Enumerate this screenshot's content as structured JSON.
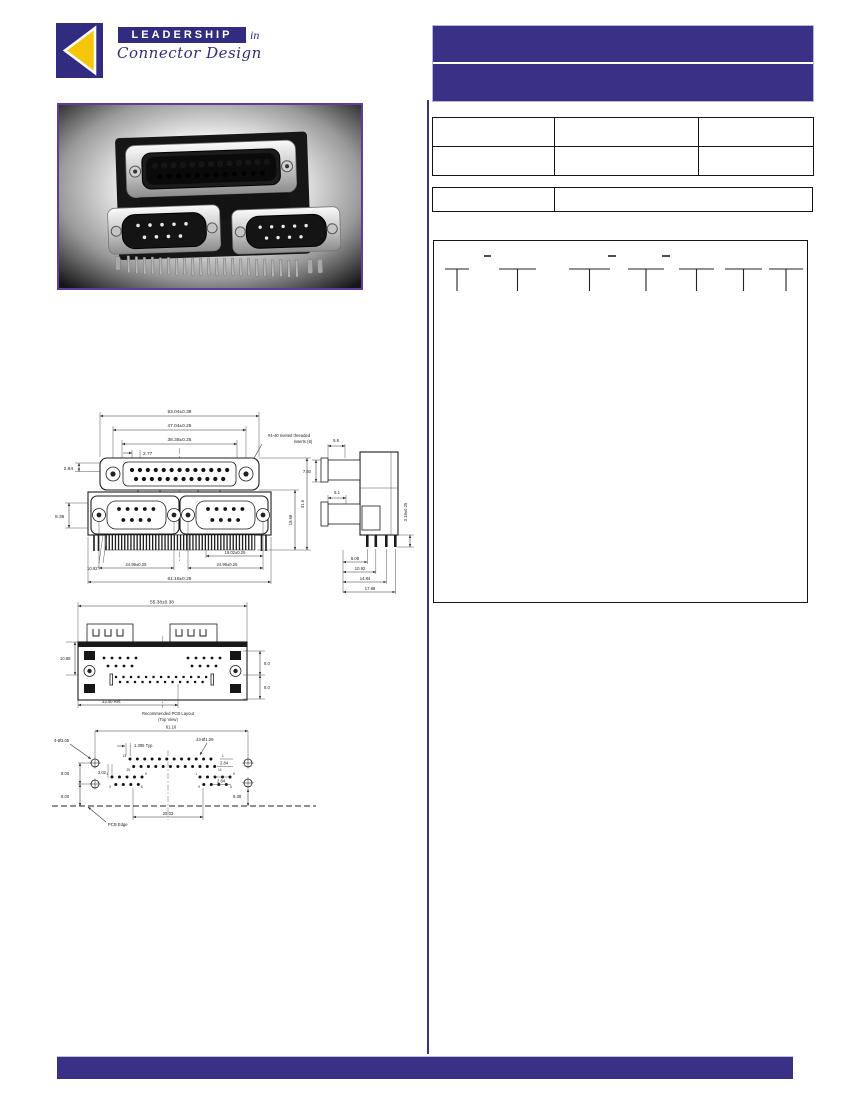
{
  "logo": {
    "leadership": "LEADERSHIP",
    "in": "in",
    "tagline": "Connector Design"
  },
  "colors": {
    "purple": "#3a3187",
    "navy": "#322c80",
    "yellow": "#f5c60a",
    "photo_border": "#5e3d9c"
  },
  "front_view": {
    "dim_width_outer": "53.04±0.38",
    "dim_width_screws": "47.04±0.25",
    "dim_width_face": "38.38±0.25",
    "dim_pin_pitch": "2.77",
    "dim_offset_left": "2.84",
    "dim_db9_offset": "8.36",
    "callout_line1": "#4-40 riveted threaded",
    "callout_line2": "inserts (6)",
    "dim_height_inner": "19.68",
    "dim_height_total": "31.6",
    "dim_angle": "10.92°",
    "dim_db9_screws_left": "24.99±0.25",
    "dim_db9_face": "19.02±0.25",
    "dim_db9_screws_right": "24.99±0.25",
    "dim_width_total": "61.16±0.25"
  },
  "side_view": {
    "dim_top": "5.8",
    "dim_front": "7.50",
    "dim_lower": "6.1",
    "dim_pin": "3.18±0.25",
    "d1": "8.08",
    "d2": "10.92",
    "d3": "14.84",
    "d4": "17.88"
  },
  "rear_view": {
    "dim_width": "55.38±0.38",
    "dim_height": "10.89",
    "dim_ref": "33.40 Ref.",
    "dim_sp1": "8.0",
    "dim_sp2": "8.0"
  },
  "pcb": {
    "title": "Recommended PCB Layout",
    "subtitle": "(Top View)",
    "dim_width": "61.16",
    "callout_mount": "4-Ø3.05",
    "callout_pins": "43-Ø1.09",
    "dim_pitch": "1.385 Typ.",
    "dim_row_offset": "2.84",
    "dim_col_offset": "3.02",
    "dim_v1": "8.00",
    "dim_v2": "8.00",
    "dim_row_offset2": "2.84",
    "dim_edge": "8.38",
    "dim_center": "25.03",
    "edge_label": "PCB Edge",
    "pins": {
      "p1": "1",
      "p5": "5",
      "p6": "6",
      "p9": "9",
      "p13": "13",
      "p14": "14",
      "p25": "25"
    }
  }
}
